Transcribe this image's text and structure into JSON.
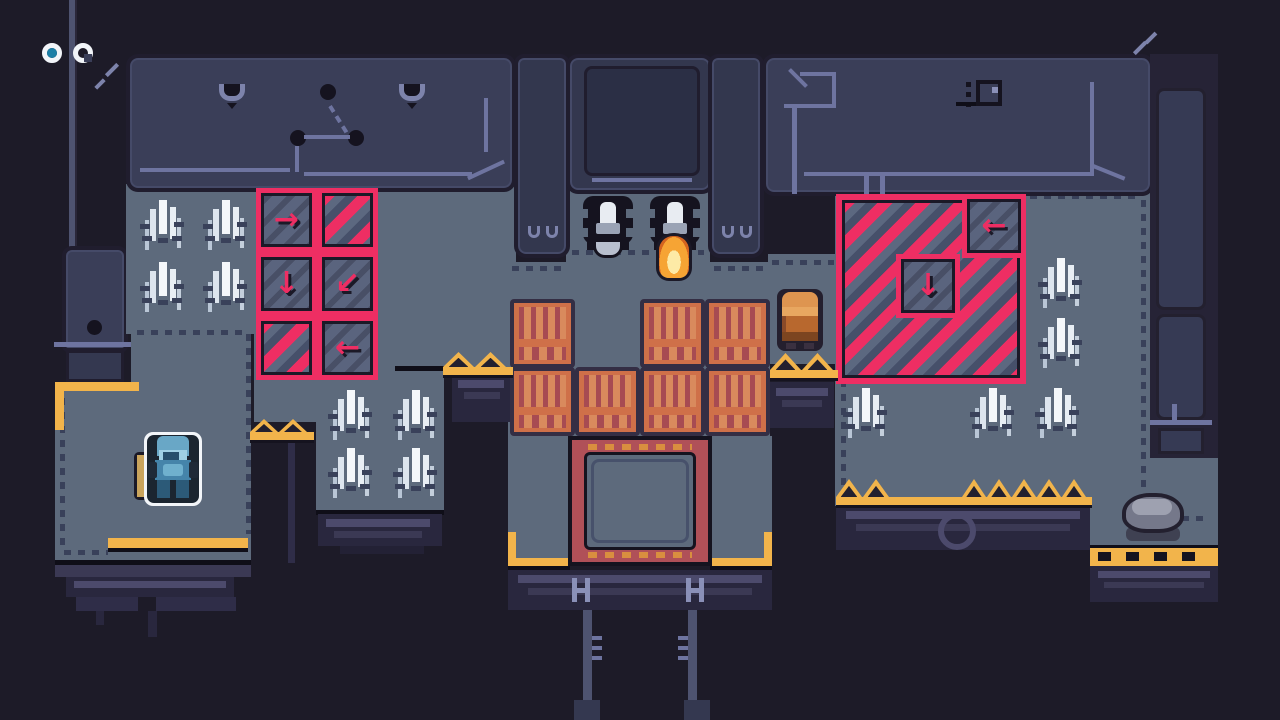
{
  "hud": {
    "orbs": [
      {
        "id": "progress-orb-1",
        "filled": true,
        "fill_color": "#1b7fa6"
      },
      {
        "id": "progress-orb-2",
        "filled": false
      }
    ]
  },
  "palette": {
    "background": "#1d1b28",
    "floor": "#5d6a7c",
    "wall_panel": "#3a3e58",
    "outline": "#15131f",
    "hazard_pink": "#ee2e63",
    "hazard_gray": "#5c6880",
    "accent_yellow": "#f2b44b",
    "hatch_red": "#b05058",
    "hatch_dash_orange": "#d98e3f",
    "crate_orange": "#cf7049",
    "crate_maroon": "#a74b52",
    "understructure": "#29273e",
    "pipe_line": "#6e74a0",
    "player_blue": "#4584aa",
    "npc_orange": "#b8682e",
    "flame_orange": "#f6a434",
    "grass_white": "#f4f7fa",
    "rock_gray": "#75788a"
  },
  "scene": {
    "conveyors": {
      "glyphs": {
        "arrow-right": "→",
        "arrow-left": "←",
        "arrow-down": "↓",
        "arrow-down-left": "↙"
      },
      "left_grid": {
        "x": 256,
        "y": 188,
        "tile_w": 61,
        "tile_h": 64,
        "rows": [
          [
            "arrow-right",
            "stripes"
          ],
          [
            "arrow-down",
            "arrow-down-left"
          ],
          [
            "stripes",
            "arrow-left"
          ]
        ]
      },
      "right_zone": {
        "big": {
          "x": 836,
          "y": 194,
          "size": 190
        },
        "tiles": [
          {
            "dir": "arrow-left",
            "x": 962,
            "y": 194,
            "size": 64
          },
          {
            "dir": "arrow-down",
            "x": 896,
            "y": 254,
            "size": 64
          }
        ]
      }
    },
    "crates": {
      "w": 65,
      "h": 69,
      "positions": [
        [
          510,
          299
        ],
        [
          640,
          299
        ],
        [
          705,
          299
        ],
        [
          510,
          367
        ],
        [
          575,
          367
        ],
        [
          640,
          367
        ],
        [
          705,
          367
        ]
      ]
    },
    "grass": {
      "positions": [
        [
          140,
          198
        ],
        [
          203,
          198
        ],
        [
          140,
          260
        ],
        [
          203,
          260
        ],
        [
          328,
          388
        ],
        [
          393,
          388
        ],
        [
          328,
          446
        ],
        [
          393,
          446
        ],
        [
          1038,
          256
        ],
        [
          1038,
          316
        ],
        [
          843,
          386
        ],
        [
          970,
          386
        ],
        [
          1035,
          386
        ]
      ]
    },
    "trusses": [
      {
        "x": 443,
        "y": 352,
        "width": 70,
        "tris": 2,
        "tri_w": 31,
        "tri_h": 15
      },
      {
        "x": 770,
        "y": 353,
        "width": 68,
        "tris": 2,
        "tri_w": 31,
        "tri_h": 17
      },
      {
        "x": 250,
        "y": 419,
        "width": 64,
        "tris": 2,
        "tri_w": 28,
        "tri_h": 13
      },
      {
        "x": 836,
        "y": 479,
        "width": 58,
        "bar_w": 256,
        "tris": 2,
        "tri_w": 26,
        "tri_h": 18
      },
      {
        "x": 962,
        "y": 479,
        "width": 129,
        "tris": 5,
        "tri_w": 24,
        "tri_h": 18
      }
    ],
    "turrets": [
      {
        "x": 583,
        "y": 196,
        "attachment": "shield"
      },
      {
        "x": 650,
        "y": 196,
        "attachment": "flame"
      }
    ],
    "entities": {
      "player": {
        "label": "blue robot (active, outlined)",
        "x": 144,
        "y": 432
      },
      "pad": {
        "label": "tan pad",
        "x": 134,
        "y": 452
      },
      "npc": {
        "label": "orange robed robot",
        "x": 777,
        "y": 289
      },
      "rock": {
        "label": "boulder",
        "x": 1120,
        "y": 485
      }
    }
  }
}
